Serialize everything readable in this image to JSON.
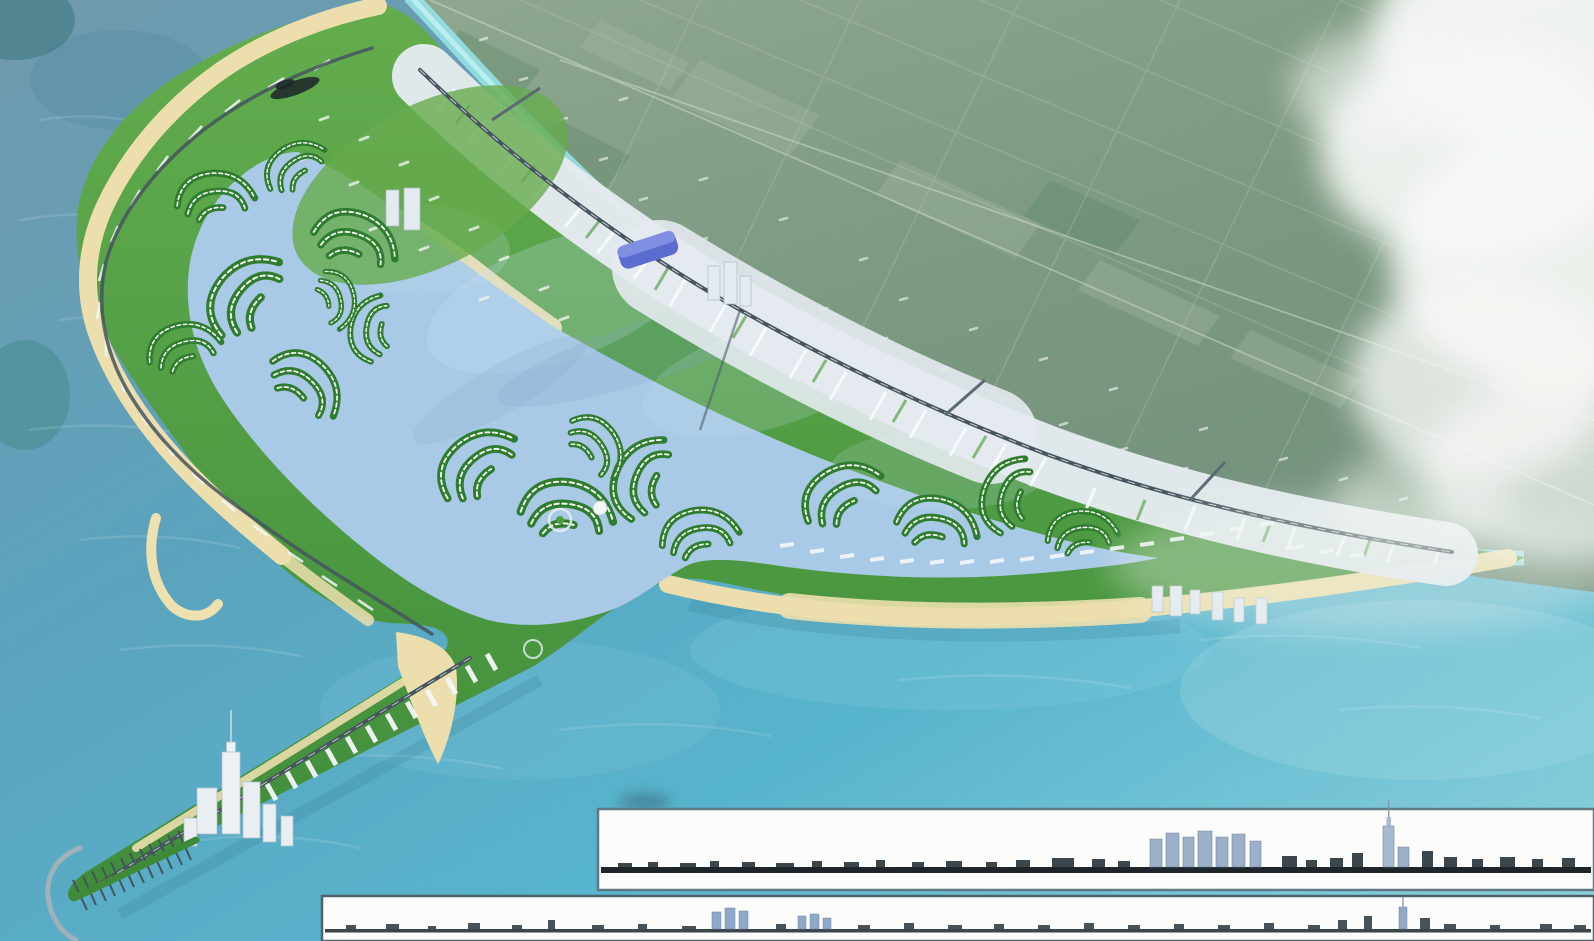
{
  "meta": {
    "title": "Aerial masterplan rendering — crescent coastal reclamation city",
    "description": "Bird's-eye 3D rendering of a crescent-shaped reclaimed island city: inner lagoon with swirling canal-villa communities, sandy outer beaches, a dense beachfront urban strip along a cyan coastal channel, mainland farmland to the north-east under a large cloud bank, a south-west spit with a CBD spire tower and marina jetty with breakwater, and two white architectural skyline-elevation strips overlaid at the bottom right. No text is visible in the image.",
    "visible_text": "none"
  },
  "palette": {
    "sea_deep": "#7199ac",
    "sea_mid": "#5ba3bd",
    "sea_turquoise": "#57b4cd",
    "sea_light": "#8ed2de",
    "lagoon": "#a8cae6",
    "sand": "#ecdfad",
    "dune_green": "#cfe0a0",
    "island_green": "#4f9c42",
    "community_green": "#2e7c2e",
    "urban_light": "#e4eaef",
    "mainland": "#839c85",
    "channel": "#93dde2",
    "road_dark": "#46555e",
    "cloud_white": "#f6f8f5",
    "panel_bg": "#fcfcfa",
    "panel_border": "#5f7884",
    "silhouette_dark": "#2b363e",
    "silhouette_blue": "#9cb1c9",
    "stadium_blue": "#5b6bd0"
  },
  "scene": {
    "regions": [
      "open-sea",
      "mainland-farmland",
      "coastal-channel",
      "crescent-island",
      "inner-lagoon",
      "canal-communities",
      "beachfront-urban-strip",
      "inner-lagoon-beach",
      "south-beach",
      "pocket-beach",
      "sandbar",
      "southwest-spit",
      "cbd-tower-cluster",
      "marina-jetty",
      "breakwater",
      "cloud-bank"
    ],
    "landmarks": [
      "cbd-spire-skyscraper",
      "stadium-blue-roof",
      "dark-pavilion",
      "white-dome",
      "roundabouts",
      "channel-bridges",
      "jetty-piers"
    ]
  },
  "elevation_panels": {
    "upper": {
      "position": "bottom-right",
      "content": "skyline elevation strip: low waterfront silhouette, mid-rise tower cluster, tall spire tower near right"
    },
    "lower": {
      "position": "bottom-edge",
      "content": "skyline elevation strip: long low silhouette, twin blue tower groups, thin spire tower at far right"
    }
  }
}
